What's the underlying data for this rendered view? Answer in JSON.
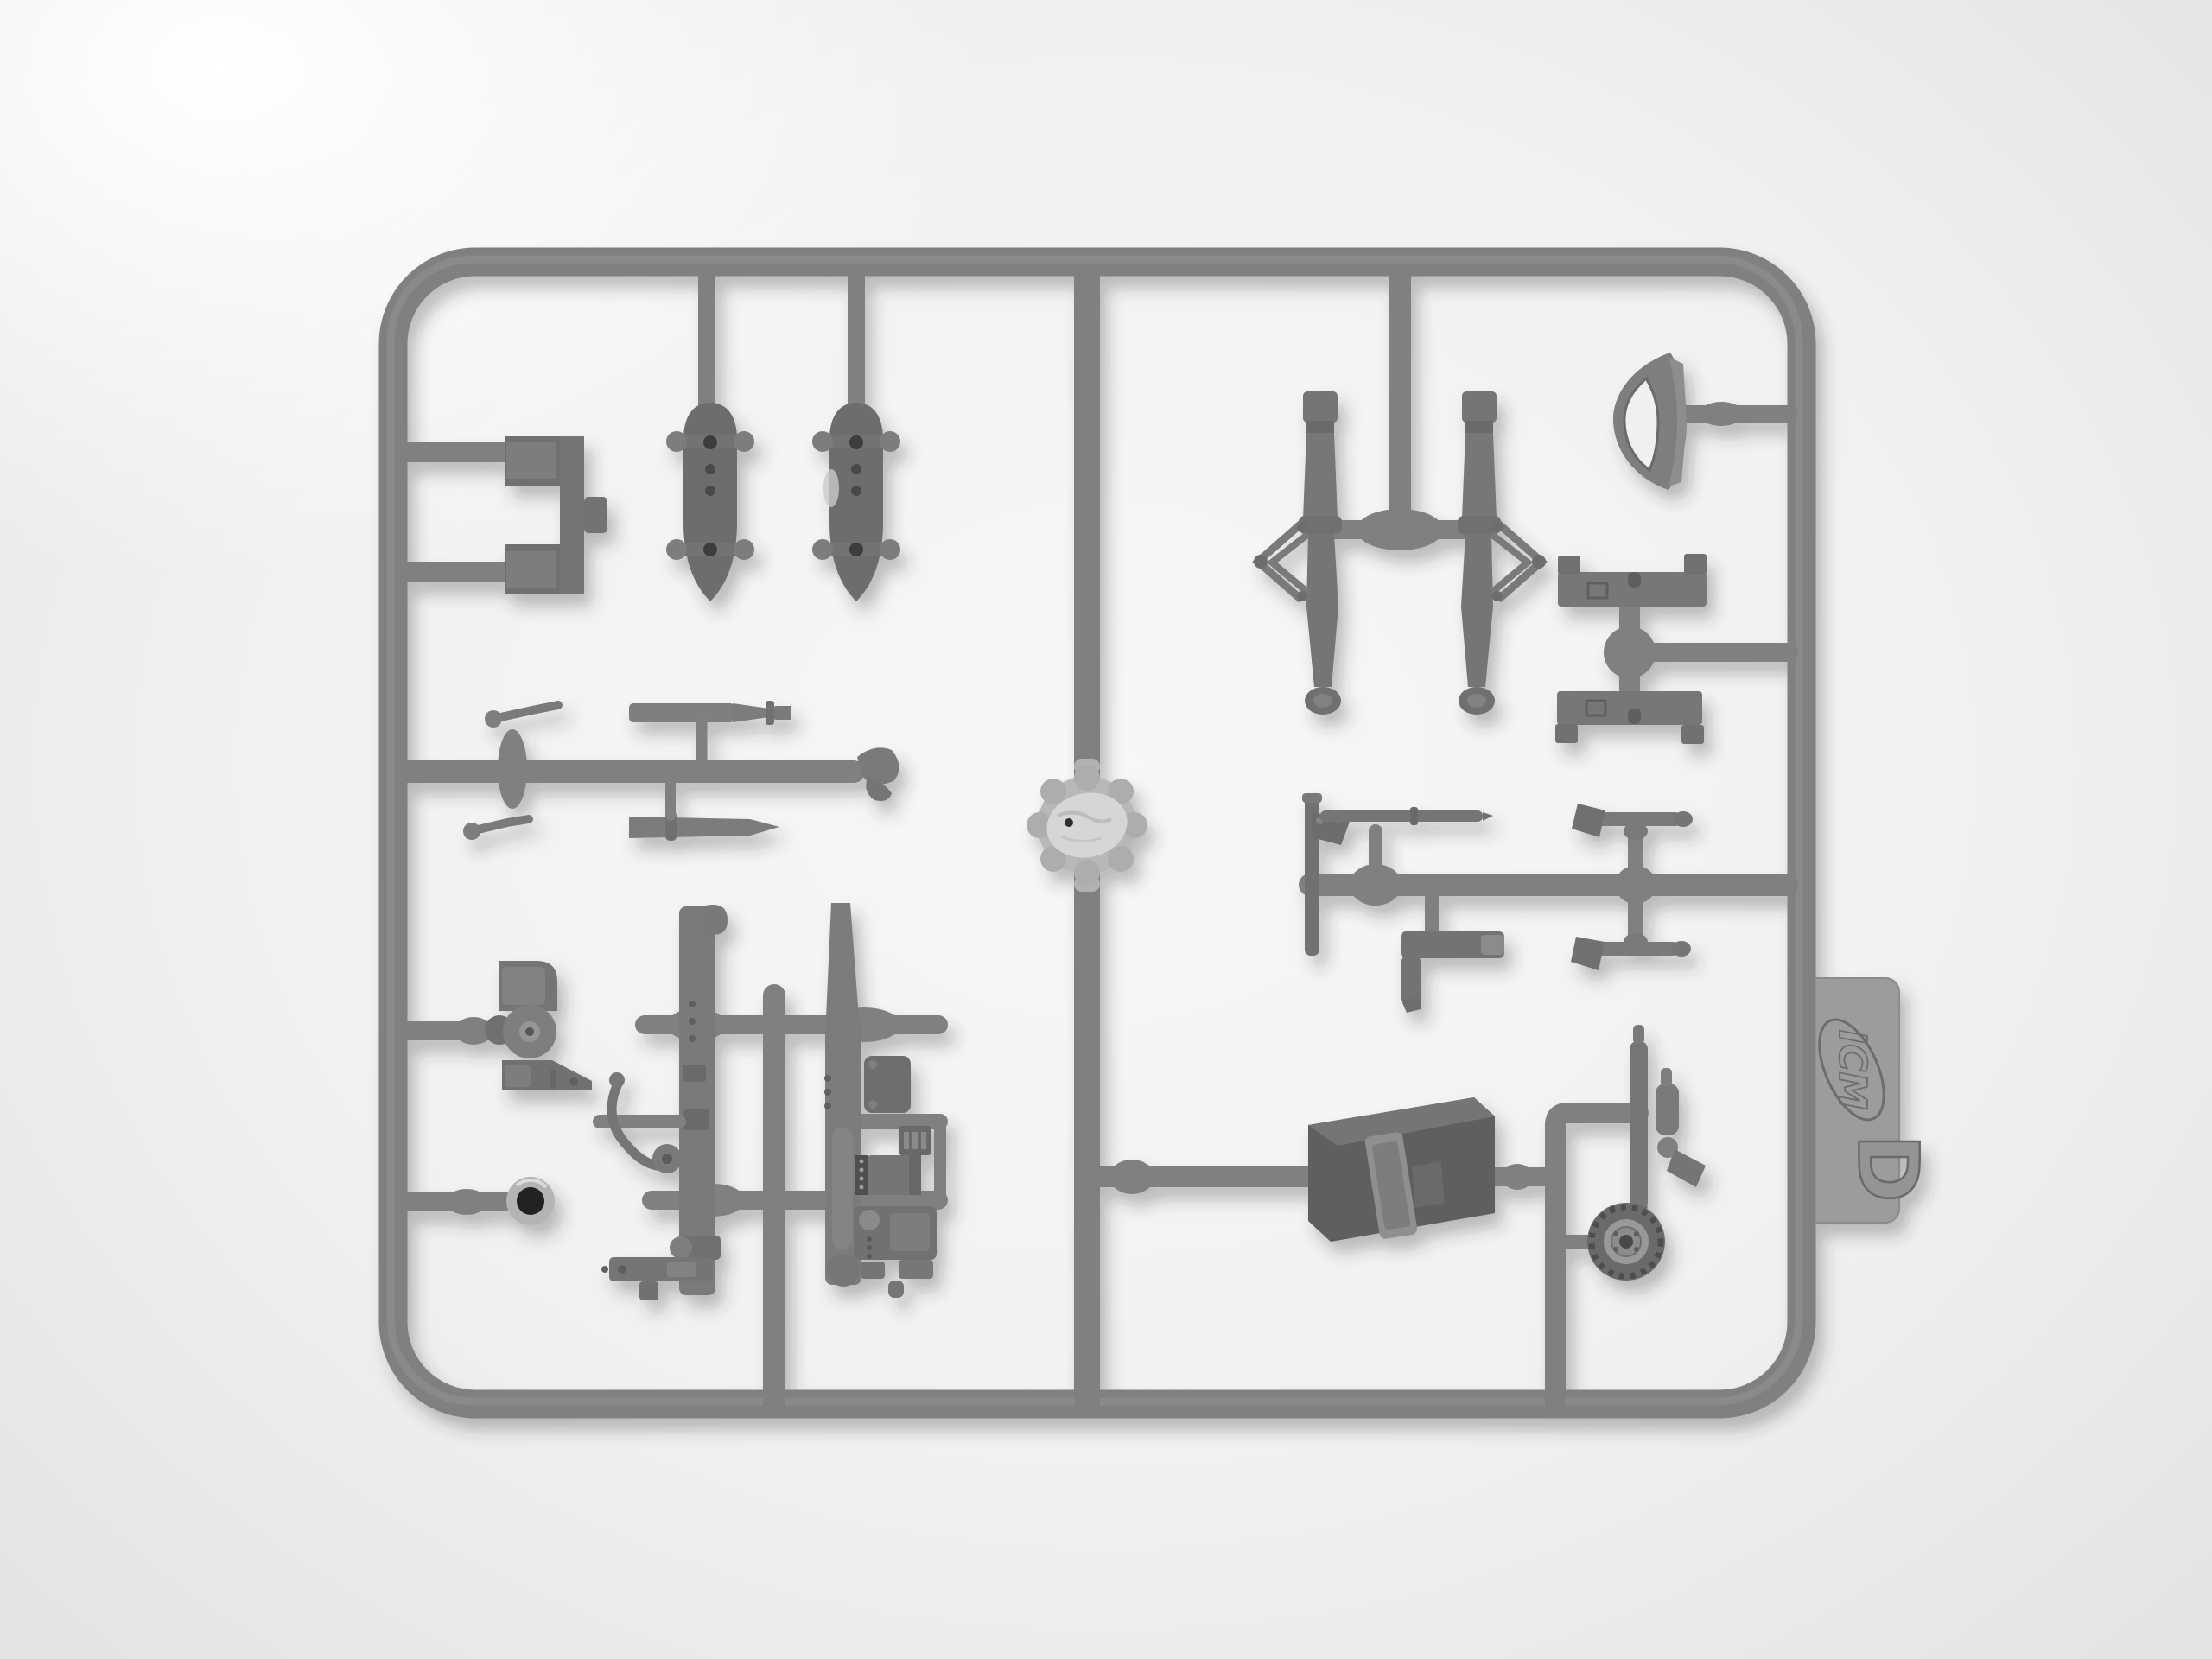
{
  "scene": {
    "type": "photograph",
    "subject": "Gray injection-molded plastic model kit sprue (styrene parts frame) photographed on a white seamless background",
    "background": "plain white studio backdrop, soft shadow under the sprue"
  },
  "palette": {
    "background": "#f1f1ef",
    "background_bright": "#ffffff",
    "background_edge": "#e3e3e1",
    "plastic_runner": "#808080",
    "plastic_mid": "#757575",
    "plastic_dark": "#5e5e5e",
    "plastic_light": "#b9b9b9",
    "gate_shiny": "#d6d6d6",
    "tab": "#9c9c9c"
  },
  "sprue": {
    "tab": {
      "brand": "ICM",
      "letter": "D"
    },
    "frame": "rectangular outer runner frame with rounded corners",
    "parts": [
      {
        "id": "mounting-bracket",
        "label": "U-shaped mounting bracket",
        "location": "upper left"
      },
      {
        "id": "float-left",
        "label": "Bomb/float body with side mounting lugs",
        "location": "upper left"
      },
      {
        "id": "float-right",
        "label": "Bomb/float body with side mounting lugs",
        "location": "upper left"
      },
      {
        "id": "detail-runner",
        "label": "Small levers, gun barrel, tapered rod and intake scoop on horizontal runner",
        "location": "mid left"
      },
      {
        "id": "injection-gate",
        "label": "Shiny circular injection-gate boss on central runner",
        "location": "center"
      },
      {
        "id": "breech-block",
        "label": "Gun breech block with circular drum",
        "location": "lower left"
      },
      {
        "id": "grommet-ring",
        "label": "Ring part with open center",
        "location": "lower left"
      },
      {
        "id": "sidewall-left",
        "label": "Cockpit sidewall frame with control stick lever",
        "location": "bottom center"
      },
      {
        "id": "sidewall-right",
        "label": "Cockpit sidewall frame with equipment boxes",
        "location": "bottom center"
      },
      {
        "id": "floor-rail",
        "label": "L-shaped floor rail",
        "location": "bottom center"
      },
      {
        "id": "gear-strut-left",
        "label": "Landing-gear oleo strut with scissor brace",
        "location": "upper right"
      },
      {
        "id": "gear-strut-right",
        "label": "Landing-gear oleo strut with scissor brace",
        "location": "upper right"
      },
      {
        "id": "headrest-fairing",
        "label": "Crescent-shaped head-rest fairing",
        "location": "top right"
      },
      {
        "id": "bomb-rack-upper",
        "label": "Rack rail with end feet",
        "location": "right"
      },
      {
        "id": "bomb-rack-lower",
        "label": "Rack rail with end feet",
        "location": "right"
      },
      {
        "id": "machine-gun",
        "label": "Machine gun with angled mount and long barrel",
        "location": "mid right"
      },
      {
        "id": "ammo-chute",
        "label": "L-shaped ammunition chute",
        "location": "mid right"
      },
      {
        "id": "control-lever-upper",
        "label": "Small control lever with angled head",
        "location": "mid right"
      },
      {
        "id": "control-lever-lower",
        "label": "Small control lever with angled head",
        "location": "mid right"
      },
      {
        "id": "equipment-box",
        "label": "Large equipment box with latch strap",
        "location": "bottom right"
      },
      {
        "id": "tail-wheel",
        "label": "Tail wheel with strut, cylinder and valve",
        "location": "bottom right"
      }
    ]
  }
}
